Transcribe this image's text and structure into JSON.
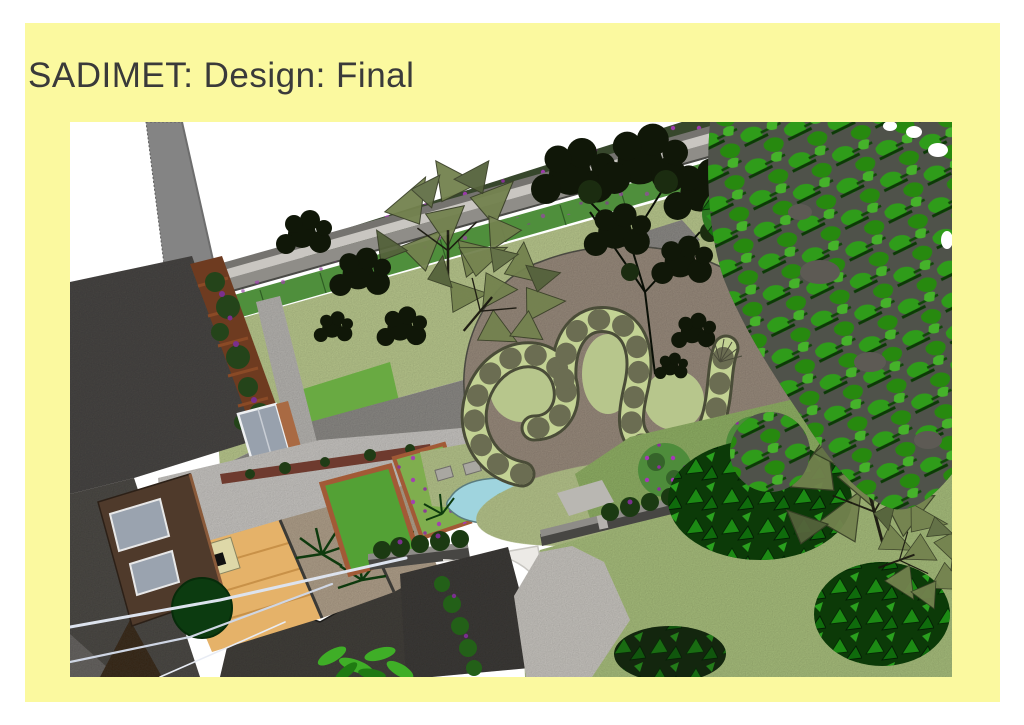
{
  "slide": {
    "title": "SADIMET: Design: Final"
  },
  "figure": {
    "label": "garden-design-aerial-render",
    "features": [
      "house-roof",
      "neighbor-wall",
      "pergola",
      "back-wall",
      "lawn",
      "paths",
      "gravel-bed",
      "serpentine-turf-bench",
      "pond",
      "raised-beds",
      "decking",
      "pebble-beds",
      "white-patio-circle",
      "garden-wall",
      "shrubs",
      "trees"
    ]
  },
  "colors": {
    "page_bg": "#ffffff",
    "slide_bg": "#fbf99f",
    "title_text": "#3a3a3a",
    "render_sky": "#ffffff",
    "lawn_upper": "#bccb90",
    "lawn_lower": "#aac17f",
    "path_grey": "#8e8c88",
    "patio_grey": "#cac8c4",
    "gravel_brown": "#9b8d7f",
    "turf_bench_green": "#c3d294",
    "roof_dark": "#4c4a47",
    "neighbor_wall_grey": "#848484",
    "brick": "#a25a36",
    "decking_tan": "#e5b269",
    "pond_blue": "#9fd4de",
    "tree_canopy_bright": "#2f9c1a",
    "tree_dark": "#101708",
    "sculpture_olive": "#73824f",
    "hedge_green": "#4f8f3c",
    "flower_purple": "#a638b8",
    "garden_wall_dark": "#474643",
    "white_patio": "#eceae6"
  }
}
